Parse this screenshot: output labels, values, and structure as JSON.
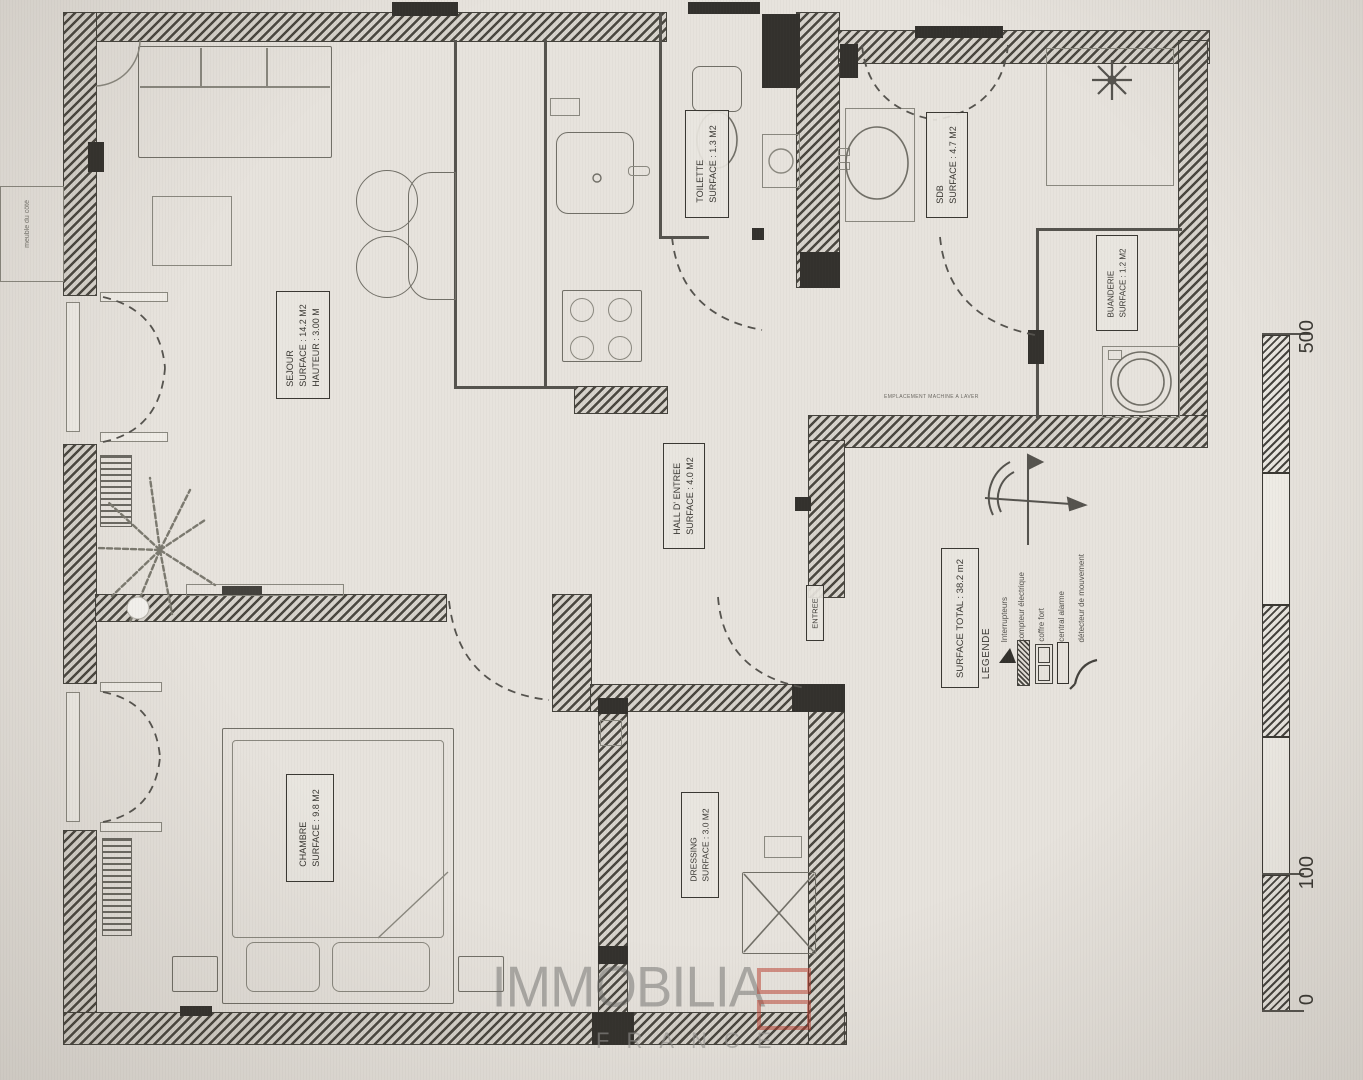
{
  "document": {
    "type": "floor-plan photo"
  },
  "rooms": {
    "sejour": {
      "name": "SEJOUR",
      "surface": "SURFACE : 14.2 M2",
      "hauteur": "HAUTEUR : 3.00 M"
    },
    "toilette": {
      "name": "TOILETTE",
      "surface": "SURFACE : 1.3 M2"
    },
    "sdb": {
      "name": "SDB",
      "surface": "SURFACE : 4.7 M2"
    },
    "buanderie": {
      "name": "BUANDERIE",
      "surface": "SURFACE : 1.2 M2"
    },
    "hall": {
      "name": "HALL D' ENTREE",
      "surface": "SURFACE : 4.0 M2"
    },
    "entree": {
      "name": "ENTREE"
    },
    "chambre": {
      "name": "CHAMBRE",
      "surface": "SURFACE : 9.8 M2"
    },
    "dressing": {
      "name": "DRESSING",
      "surface": "SURFACE : 3.0 M2"
    }
  },
  "summary": {
    "surface_total": "SURFACE TOTAL : 38.2 m2"
  },
  "legend": {
    "title": "LEGENDE",
    "items": [
      {
        "label": "Interrupteurs",
        "icon": "switch-icon"
      },
      {
        "label": "compteur électrique",
        "icon": "electric-meter-icon"
      },
      {
        "label": "coffre fort",
        "icon": "safe-icon"
      },
      {
        "label": "central alarme",
        "icon": "alarm-panel-icon"
      },
      {
        "label": "détecteur de mouvement",
        "icon": "motion-detector-icon"
      }
    ]
  },
  "scale_bar": {
    "labels": [
      "500",
      "100",
      "0"
    ]
  },
  "annotations": {
    "exterior_note": "meuble du côté",
    "sdb_note": "EMPLACEMENT MACHINE A LAVER"
  },
  "watermark": {
    "brand": "IMMOBILIA",
    "country": "FRANCE"
  },
  "colors": {
    "paper": "#e6e2dc",
    "line": "#55534e",
    "wall": "#3a3833",
    "watermark_gray": "#8f8f8d",
    "logo_red": "#c23b2e"
  }
}
